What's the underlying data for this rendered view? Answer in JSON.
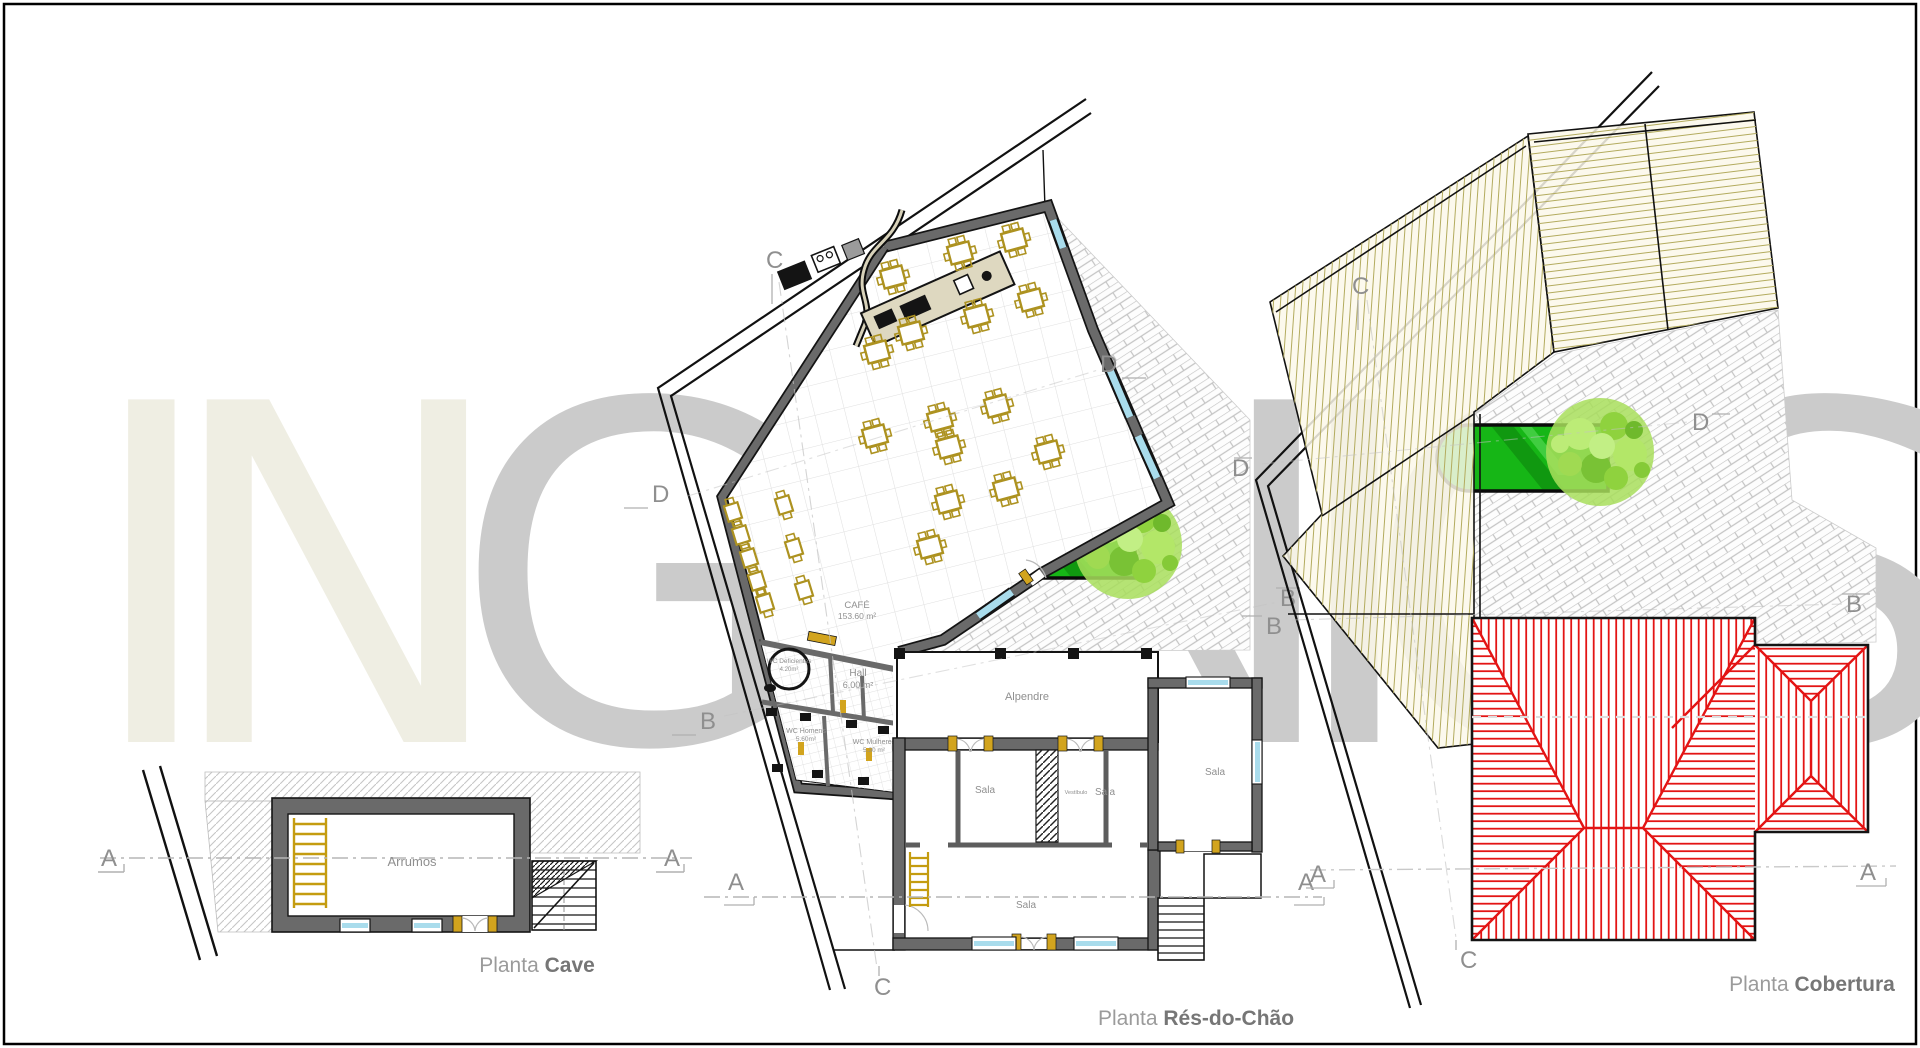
{
  "watermark": {
    "left": "IN",
    "right": "GENIOS",
    "color_left": "#efeee3",
    "color_right": "#cbcbcb"
  },
  "plan_labels": {
    "prefix": "Planta ",
    "cave": "Cave",
    "ground": "Rés-do-Chão",
    "roof": "Cobertura"
  },
  "rooms": {
    "arrumos": "Arrumos",
    "cafe": "CAFÉ",
    "cafe_area": "153.60 m²",
    "hall": "Hall",
    "hall_area": "6.00 m²",
    "wc_def": "WC Deficientes",
    "wc_def_area": "4.20m²",
    "wc_homens": "WC Homens",
    "wc_homens_area": "5.60m²",
    "wc_mulheres": "WC Mulheres",
    "wc_mulheres_area": "5.30 m²",
    "alpendre": "Alpendre",
    "sala": "Sala",
    "vestibulo": "Vestíbulo"
  },
  "sections": {
    "a": "A",
    "b": "B",
    "c": "C",
    "d": "D"
  },
  "colors": {
    "wall_gray": "#6a6a6a",
    "wall_edge": "#141414",
    "window_cyan": "#a9dcec",
    "furniture_yellow": "#ad9220",
    "door_yellow": "#d2a41e",
    "hatch_gray": "#c6c6c6",
    "brick_joint": "#c4c4c4",
    "flat_roof_hatch": "#b3ab5e",
    "roof_red": "#e31414",
    "pool_green": "#16b616",
    "pool_dark": "#0f930f",
    "tree_green": "#a8de5c",
    "marker_gray": "#8f8f8f",
    "section_line": "#b5b5b5"
  }
}
